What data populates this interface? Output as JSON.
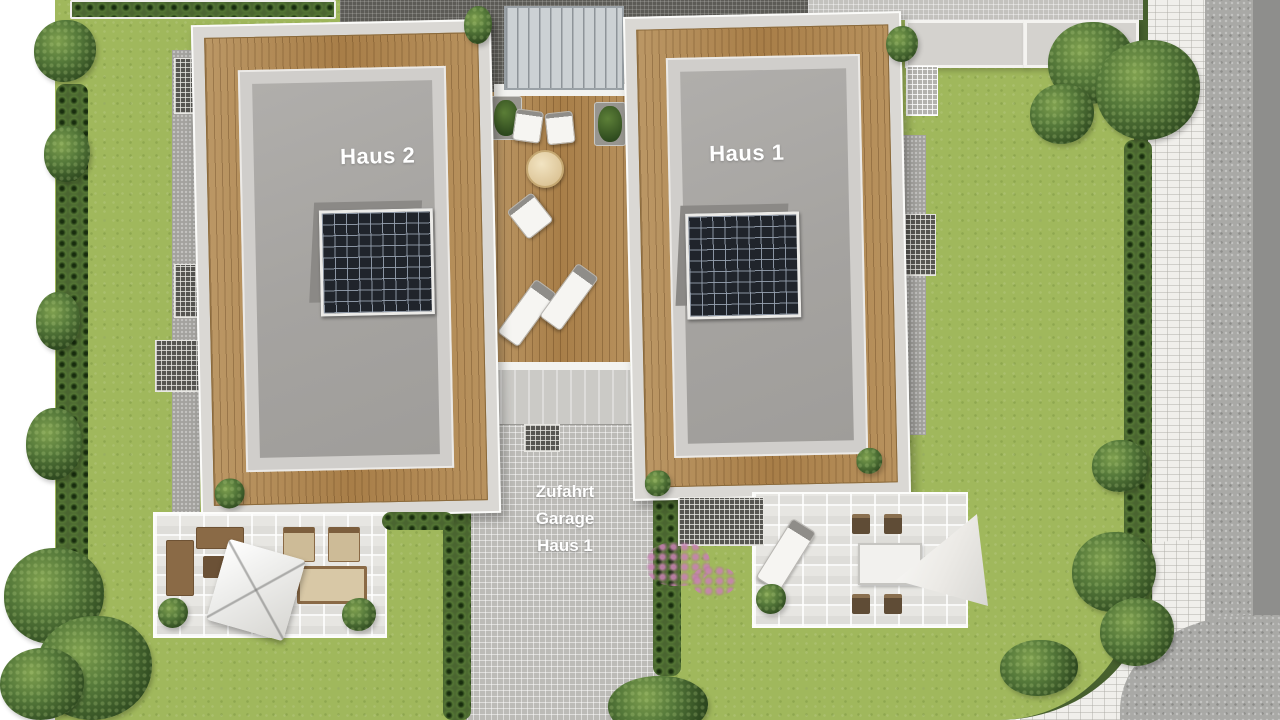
{
  "meta": {
    "type": "architectural-site-plan",
    "view": "top-down color rendering of a two-house residential plot"
  },
  "labels": {
    "haus2": "Haus 2",
    "haus1": "Haus 1",
    "zufahrt_lines": [
      "Zufahrt",
      "Garage",
      "Haus 1"
    ]
  },
  "colors": {
    "lawn": "#a0b85c",
    "hedge": "#4a6530",
    "house_outer_frame": "#dad8d4",
    "roof": "#a5a3a0",
    "wood_deck": "#b08851",
    "solar_panel": "#20242b",
    "driveway_pavers": "#bcbbb7",
    "patio_pavers": "#e7e6e2",
    "sidewalk": "#f0efeb",
    "road": "#a9a9a6",
    "road_edge": "#8e8e8c",
    "label_text": "#ffffff"
  },
  "features": {
    "houses": [
      {
        "id": "haus-2",
        "label": "Haus 2",
        "solar_panel": true,
        "wood_deck_border": true
      },
      {
        "id": "haus-1",
        "label": "Haus 1",
        "solar_panel": true,
        "wood_deck_border": true
      }
    ],
    "central_terrace": "wooden deck with loungers, chairs and round table between the houses",
    "driveway": "paved driveway labeled Zufahrt Garage Haus 1 running to the bottom edge",
    "patios": [
      "left garden patio with square parasol and lounge furniture",
      "right garden patio with lounger, dining set and parasol"
    ],
    "surroundings": "lawns, hedges and trees; paver sidewalk and grey road along the right edge"
  }
}
